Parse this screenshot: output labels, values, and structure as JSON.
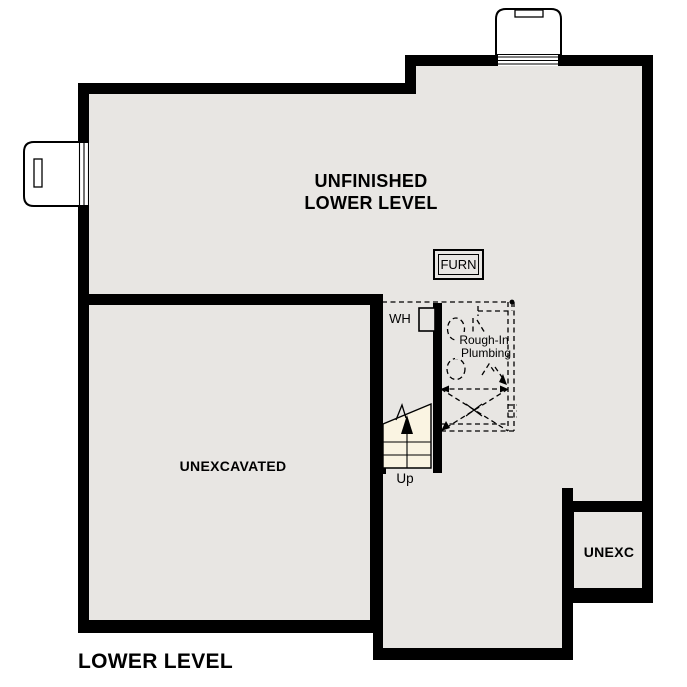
{
  "page_title": "LOWER LEVEL",
  "colors": {
    "floor": "#e8e6e3",
    "stairs_fill": "#faf4e2",
    "wall": "#000000",
    "background": "#ffffff"
  },
  "rooms": {
    "unfinished_lower_level": {
      "label_line1": "UNFINISHED",
      "label_line2": "LOWER LEVEL"
    },
    "unexcavated": {
      "label": "UNEXCAVATED"
    },
    "unexc": {
      "label": "UNEXC"
    }
  },
  "equipment": {
    "furnace": {
      "label": "FURN"
    },
    "water_heater": {
      "label": "WH"
    }
  },
  "stairs": {
    "direction_label": "Up"
  },
  "plumbing": {
    "label_line1": "Rough-In",
    "label_line2": "Plumbing"
  }
}
